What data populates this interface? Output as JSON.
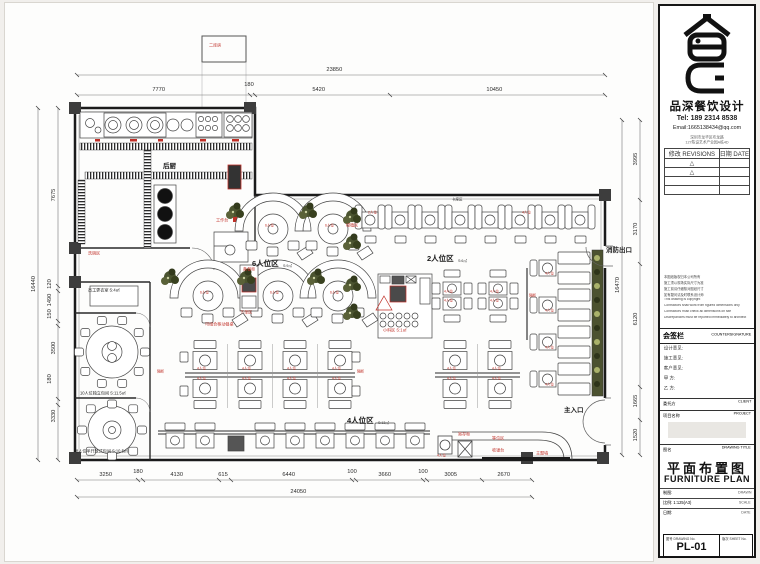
{
  "panel": {
    "company": "品深餐饮设计",
    "tel": "Tel: 189 2314 8538",
    "email": "Email:1665138434@qq.com",
    "addr1": "深圳市龙华区布龙路",
    "addr2": "127陈设艺术产业园A栋4D",
    "rev": {
      "h1": "修改 REVISIONS",
      "h2": "日期 DATE",
      "rows": [
        {
          "m": "△",
          "d": ""
        },
        {
          "m": "△",
          "d": ""
        }
      ]
    },
    "notes": [
      "本图纸版权归本公司所有",
      "施工须以现场实际尺寸为准",
      "施工前请仔细核对图纸尺寸",
      "如有疑问请及时联系设计师",
      "This drawing is copyright",
      "Contractors shall work from figured dimensions only",
      "Contractors must check all dimensions on site",
      "Discrepancies must be reported immediately to architect"
    ],
    "cs_cn": "会签栏",
    "cs_en": "COUNTERSIGNATURE",
    "sig": [
      "设计意见:",
      "施工意见:",
      "客户意见:",
      "甲  方:",
      "乙  方:"
    ],
    "client_cn": "委托方",
    "client_en": "CLIENT",
    "project_cn": "项目名称",
    "project_en": "PROJECT",
    "title_lbl_cn": "图名",
    "title_lbl_en": "DRAWING TITLE",
    "title_cn": "平面布置图",
    "title_en": "FURNITURE PLAN",
    "meta": [
      {
        "l": "制图:",
        "r": "DRAWN"
      },
      {
        "l": "比例: 1:125(A3)",
        "r": "SCALE"
      },
      {
        "l": "日期:",
        "r": "DATE"
      }
    ],
    "no_cn": "图号",
    "no_en": "DRAWING No.",
    "sheet_no": "PL-01",
    "ver_cn": "版次",
    "ver_en": "SHEET No."
  },
  "dims": {
    "top_total": "23850",
    "top": [
      "7770",
      "180",
      "5420",
      "10450"
    ],
    "bottom": [
      "3250",
      "180",
      "4130",
      "615",
      "6440",
      "100",
      "3660",
      "100",
      "3005",
      "2670"
    ],
    "bottom_total": "24050",
    "left": [
      "7675",
      "120",
      "1490",
      "150",
      "3500",
      "180",
      "3330"
    ],
    "left_total": "16440",
    "right": [
      "3995",
      "3170",
      "6120",
      "1665",
      "1520"
    ],
    "right_total": "16470"
  },
  "plan": {
    "kitchen": "后厨",
    "annex": "二库房",
    "workbench": "工作台",
    "wash": "洗碗区",
    "staff_room": "员工更衣室 S:4㎡",
    "room10": "10人位独立包间 S:11.5㎡",
    "room8": "8人位半开放式包间 S:10.5㎡",
    "zone6": "6人位区",
    "zone6_area": "S:9㎡",
    "zone2": "2人位区",
    "zone2_area": "S:6㎡",
    "zone4": "4人位区",
    "zone4_area": "S:13㎡",
    "kazuo": "卡座区",
    "spice": "小料区 S:1㎡",
    "fire_exit": "消防出口",
    "entrance": "主入口",
    "prep": "备餐柜",
    "order": "下单区",
    "movable": "可组合移动餐桌",
    "plant_tag": "绿植区",
    "divider": "隔断",
    "wait": "等位区",
    "cashier": "收银台",
    "theme_wall": "主题墙",
    "locker": "寄存柜"
  },
  "tags": {
    "t2": "2人位",
    "t4": "4人位",
    "t6": "6人位"
  }
}
